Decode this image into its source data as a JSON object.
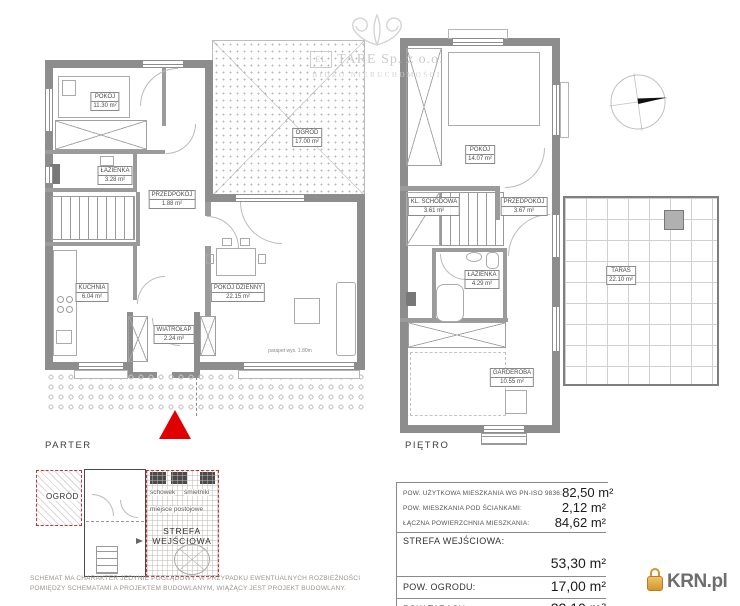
{
  "watermark": {
    "logo_text": "EL",
    "company": "TARE Sp. z o.o.",
    "subtitle": "BIURO NIERUCHOMOŚCI"
  },
  "plans": {
    "parter": {
      "label": "PARTER",
      "rooms": [
        {
          "label": "POKÓJ",
          "area": "11.30 m²"
        },
        {
          "label": "ŁAZIENKA",
          "area": "3.28 m²"
        },
        {
          "label": "PRZEDPOKÓJ",
          "area": "1.88 m²"
        },
        {
          "label": "KUCHNIA",
          "area": "6.04 m²"
        },
        {
          "label": "POKÓJ DZIENNY",
          "area": "22.15 m²"
        },
        {
          "label": "WIATROŁAP",
          "area": "2.24 m²"
        },
        {
          "label": "OGRÓD",
          "area": "17.00 m²"
        }
      ],
      "annotation": "parapet wys. 1.80m"
    },
    "pietro": {
      "label": "PIĘTRO",
      "rooms": [
        {
          "label": "POKÓJ",
          "area": "14.07 m²"
        },
        {
          "label": "KL. SCHODOWA",
          "area": "3.61 m²"
        },
        {
          "label": "PRZEDPOKÓJ",
          "area": "3.67 m²"
        },
        {
          "label": "ŁAZIENKA",
          "area": "4.29 m²"
        },
        {
          "label": "GARDEROBA",
          "area": "10.55 m²"
        },
        {
          "label": "TARAS",
          "area": "22.10 m²"
        }
      ]
    }
  },
  "site_plan": {
    "garden_label": "OGRÓD",
    "storage_label": "schowek",
    "bins_label": "śmietniki",
    "parking_label": "miejsce postojowe",
    "entrance_line1": "STREFA",
    "entrance_line2": "WEJŚCIOWA"
  },
  "area_table": {
    "rows": [
      {
        "label": "POW. UŻYTKOWA MIESZKANIA WG PN-ISO 9836:",
        "value": "82,50 m²"
      },
      {
        "label": "POW. MIESZKANIA POD ŚCIANKAMI:",
        "value": "2,12 m²"
      },
      {
        "label": "ŁĄCZNA POWIERZCHNIA MIESZKANIA:",
        "value": "84,62 m²"
      }
    ],
    "entrance_label": "STREFA WEJŚCIOWA:",
    "entrance_value": "53,30 m²",
    "garden_label": "POW. OGRODU:",
    "garden_value": "17,00 m²",
    "terrace_label": "POW.TARASU:",
    "terrace_value": "22,10 m²"
  },
  "disclaimer": {
    "line1": "SCHEMAT MA CHARAKTER JEDYNIE POGLĄDOWY. W PRZYPADKU EWENTUALNYCH ROZBIEŻNOŚCI",
    "line2": "POMIĘDZY SCHEMATAMI A PROJEKTEM BUDOWLANYM, WIĄŻĄCY JEST PROJEKT BUDOWLANY."
  },
  "logo": {
    "text": "KRN.pl"
  }
}
